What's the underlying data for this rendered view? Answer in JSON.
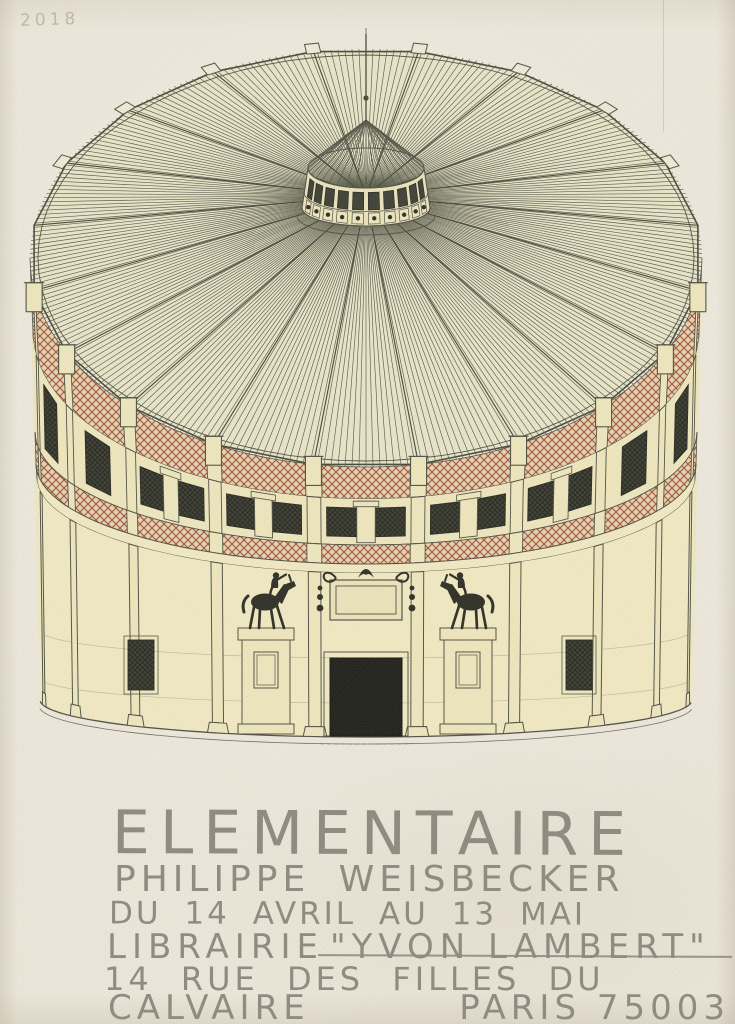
{
  "poster": {
    "year_mark": "2018",
    "title": "ELEMENTAIRE",
    "artist": "PHILIPPE WEISBECKER",
    "dates_line": "DU 14 AVRIL AU 13 MAI",
    "venue_line": {
      "prefix": "LIBRAIRIE",
      "name": "\"YVON LAMBERT\""
    },
    "address_line_1": "14 RUE DES FILLES DU",
    "address_line_2a": "CALVAIRE",
    "address_line_2b": "PARIS 75003"
  },
  "illustration": {
    "alt": "hand-drawn circular pavilion with conical ribbed roof, lantern cupola with mast, red lattice frieze bands, dark windows, central dark doorway and two equestrian statues on pedestals"
  },
  "colors": {
    "paper": "#ebe6d9",
    "wall": "#ede5bd",
    "wall_light": "#efe8c2",
    "roof": "#e8e4c9",
    "ink": "#55574a",
    "lattice_red": "#9d564a",
    "lattice_bg": "#e6d3ab",
    "dark_window": "#45463b",
    "door": "#30302a",
    "statue": "#34352c",
    "pencil": "#8f8c81",
    "faint": "#b9b2a5"
  }
}
